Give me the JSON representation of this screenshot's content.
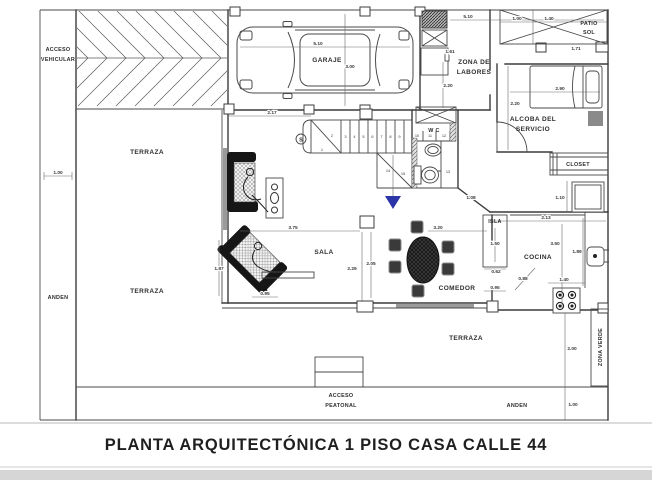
{
  "title": "PLANTA ARQUITECTÓNICA 1 PISO  CASA CALLE 44",
  "labels": {
    "acceso_vehicular": [
      "ACCESO",
      "VEHICULAR"
    ],
    "anden_left": "ANDEN",
    "anden_bottom": "ANDEN",
    "terraza_upper_left": "TERRAZA",
    "terraza_lower_left": "TERRAZA",
    "terraza_back": "TERRAZA",
    "garaje": "GARAJE",
    "zona_de_labores": [
      "ZONA DE",
      "LABORES"
    ],
    "patio_sol": [
      "PATIO",
      "SOL"
    ],
    "alcoba_del_servicio": [
      "ALCOBA DEL",
      "SERVICIO"
    ],
    "closet": "CLOSET",
    "wc": "W C",
    "sala": "SALA",
    "comedor": "COMEDOR",
    "isla": "ISLA",
    "cocina": "COCINA",
    "zona_verde": "ZONA VERDE",
    "acceso_peatonal": [
      "ACCESO",
      "PEATONAL"
    ],
    "stair_start": "S"
  },
  "dimensions": {
    "garaje_ancho": "5.10",
    "garaje_fondo": "3.00",
    "hall": "2.17",
    "labores_ancho": "5.10",
    "labores_equipo": "1.61",
    "labores_fondo": "2.20",
    "patio_izq": "1.00",
    "patio_der": "1.40",
    "patio_alto": "1.71",
    "alcoba_ancho": "2.90",
    "alcoba_fondo": "2.20",
    "nevera": "1.10",
    "cocina_ancho": "2.13",
    "cocina_fondo": "3.50",
    "meson": "1.89",
    "estufa": "1.40",
    "isla_largo": "1.50",
    "isla_ancho": "0.62",
    "puerta_cocina": "0.88",
    "isla_paso": "0.95",
    "comedor_ancho": "3.20",
    "comedor_fondo": "2.05",
    "sala_ancho": "3.75",
    "sala_fondo": "2.29",
    "sala_muro": "1.87",
    "sala_paso": "0.95",
    "escalera_diag": "1.08",
    "anden_izq": "1.00",
    "anden_inf": "1.00",
    "terraza_fondo": "2.00"
  },
  "stair_steps": [
    "1",
    "2",
    "3",
    "4",
    "5",
    "6",
    "7",
    "8",
    "9",
    "10",
    "11",
    "12",
    "13",
    "14",
    "15"
  ]
}
